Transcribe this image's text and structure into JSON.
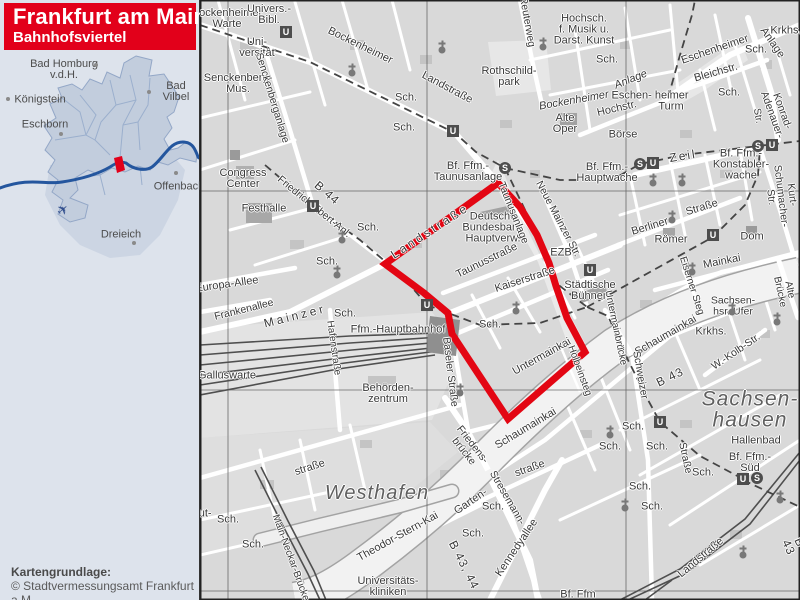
{
  "title": {
    "line1": "Frankfurt am Main",
    "line2": "Bahnhofsviertel"
  },
  "attribution": {
    "line1": "Kartengrundlage:",
    "line2": "© Stadtvermessungsamt Frankfurt a.M."
  },
  "colors": {
    "banner": "#e2001a",
    "boundary": "#e30613",
    "river_overview": "#24569e",
    "sidebar_bg": "#dde3ec"
  },
  "overview": {
    "plane_glyph": "✈",
    "towns": [
      {
        "name": "Bad Homburg\nv.d.H.",
        "x": 64,
        "y": 70,
        "dx": 96,
        "dy": 65
      },
      {
        "name": "Königstein",
        "x": 40,
        "y": 100,
        "dx": 8,
        "dy": 99
      },
      {
        "name": "Bad Vilbel",
        "x": 176,
        "y": 92,
        "dx": 149,
        "dy": 92
      },
      {
        "name": "Eschborn",
        "x": 45,
        "y": 125,
        "dx": 61,
        "dy": 134
      },
      {
        "name": "Offenbach",
        "x": 179,
        "y": 187,
        "dx": 176,
        "dy": 173
      },
      {
        "name": "Dreieich",
        "x": 121,
        "y": 235,
        "dx": 134,
        "dy": 243
      }
    ]
  },
  "map": {
    "labels": [
      {
        "t": "Bockenheimer\nWarte",
        "x": 27,
        "y": 19
      },
      {
        "t": "Univers.-\nBibl.",
        "x": 69,
        "y": 15
      },
      {
        "t": "Uni-\nversität",
        "x": 57,
        "y": 48
      },
      {
        "t": "Senckenberg-\nMus.",
        "x": 38,
        "y": 84
      },
      {
        "t": "Sch.",
        "x": 206,
        "y": 98
      },
      {
        "t": "Sch.",
        "x": 204,
        "y": 128
      },
      {
        "t": "Bockenheimer",
        "x": 160,
        "y": 46,
        "r": 26
      },
      {
        "t": "Landstraße",
        "x": 247,
        "y": 88,
        "r": 28
      },
      {
        "t": "Senckenberganlage",
        "x": 72,
        "y": 98,
        "r": 73,
        "s": 10.5
      },
      {
        "t": "Rothschild-\npark",
        "x": 309,
        "y": 77
      },
      {
        "t": "Reuterweg",
        "x": 327,
        "y": 22,
        "r": 80,
        "s": 10.5
      },
      {
        "t": "Hochsch.\nf. Musik u.\nDarst. Kunst",
        "x": 384,
        "y": 30
      },
      {
        "t": "Sch.",
        "x": 407,
        "y": 60
      },
      {
        "t": "Eschenheimer",
        "x": 515,
        "y": 50,
        "r": -19
      },
      {
        "t": "Anlage",
        "x": 572,
        "y": 43,
        "r": 55
      },
      {
        "t": "Krkhs.",
        "x": 586,
        "y": 31
      },
      {
        "t": "Sch.",
        "x": 556,
        "y": 50
      },
      {
        "t": "Sch.",
        "x": 529,
        "y": 93
      },
      {
        "t": "Bockenheimer",
        "x": 374,
        "y": 101,
        "r": -10,
        "it": 1
      },
      {
        "t": "Anlage",
        "x": 431,
        "y": 80,
        "r": -22,
        "it": 1
      },
      {
        "t": "Eschen- heimer",
        "x": 450,
        "y": 96
      },
      {
        "t": "Turm",
        "x": 471,
        "y": 107
      },
      {
        "t": "Hochstr.",
        "x": 417,
        "y": 109,
        "r": -13
      },
      {
        "t": "Alte\nOper",
        "x": 365,
        "y": 124
      },
      {
        "t": "Börse",
        "x": 423,
        "y": 135
      },
      {
        "t": "Bleichstr.",
        "x": 516,
        "y": 73,
        "r": -16
      },
      {
        "t": "Str.",
        "x": 557,
        "y": 116,
        "r": 80,
        "s": 10
      },
      {
        "t": "Konrad-Adenauer-",
        "x": 577,
        "y": 113,
        "r": 70,
        "s": 10.5
      },
      {
        "t": "Kurt-Schumacher-Str.",
        "x": 581,
        "y": 196,
        "r": 83,
        "s": 10.5
      },
      {
        "t": "Congress\nCenter",
        "x": 43,
        "y": 179
      },
      {
        "t": "Festhalle",
        "x": 64,
        "y": 209
      },
      {
        "t": "Friedrich-Ebert-Anl.",
        "x": 114,
        "y": 207,
        "r": 39,
        "s": 10.5
      },
      {
        "t": "B 44",
        "x": 127,
        "y": 193,
        "r": 41,
        "s": 12,
        "sp": 1
      },
      {
        "t": "Europa-Allee",
        "x": 27,
        "y": 285,
        "r": -8
      },
      {
        "t": "Frankenallee",
        "x": 44,
        "y": 310,
        "r": -14,
        "s": 10.5
      },
      {
        "t": "Mainzer",
        "x": 95,
        "y": 316,
        "r": -14,
        "s": 12,
        "sp": 3
      },
      {
        "t": "Landstraße",
        "x": 230,
        "y": 231,
        "r": -33,
        "s": 12,
        "sp": 3
      },
      {
        "t": "Hafenstraße",
        "x": 133,
        "y": 348,
        "r": 82,
        "s": 10
      },
      {
        "t": "Sch.",
        "x": 145,
        "y": 314
      },
      {
        "t": "Sch.",
        "x": 168,
        "y": 228
      },
      {
        "t": "Sch.",
        "x": 127,
        "y": 262
      },
      {
        "t": "Galluswarte",
        "x": 27,
        "y": 376
      },
      {
        "t": "straße",
        "x": 110,
        "y": 468,
        "r": -18
      },
      {
        "t": "Westhafen",
        "x": 177,
        "y": 493,
        "s": 20,
        "it": 1,
        "sp": 1,
        "c": "area"
      },
      {
        "t": "Main-Neckar-Brücke",
        "x": 90,
        "y": 558,
        "r": 70,
        "s": 10
      },
      {
        "t": "Sch.",
        "x": 28,
        "y": 520
      },
      {
        "t": "Sch.",
        "x": 53,
        "y": 545
      },
      {
        "t": "Gutleut-",
        "x": -8,
        "y": 514
      },
      {
        "t": "Behörden-\nzentrum",
        "x": 188,
        "y": 394
      },
      {
        "t": "Ffm.-Hauptbahnhof",
        "x": 198,
        "y": 330
      },
      {
        "t": "Bf. Ffm.-\nTaunusanlage",
        "x": 268,
        "y": 172
      },
      {
        "t": "Deutsche\nBundesbank\nHauptverw.",
        "x": 293,
        "y": 228
      },
      {
        "t": "Taunusstraße",
        "x": 287,
        "y": 261,
        "r": -26
      },
      {
        "t": "Kaiserstraße",
        "x": 325,
        "y": 280,
        "r": -18
      },
      {
        "t": "Taunusanlage",
        "x": 313,
        "y": 213,
        "r": 68,
        "s": 10.5
      },
      {
        "t": "Neue Mainzer Str.",
        "x": 358,
        "y": 219,
        "r": 62,
        "s": 10.5
      },
      {
        "t": "EZB",
        "x": 361,
        "y": 253
      },
      {
        "t": "Städtische\nBühnen",
        "x": 390,
        "y": 291
      },
      {
        "t": "Sch.",
        "x": 290,
        "y": 325
      },
      {
        "t": "Baseler Straße",
        "x": 250,
        "y": 372,
        "r": 83,
        "s": 10.5
      },
      {
        "t": "Untermainkai",
        "x": 342,
        "y": 357,
        "r": -29
      },
      {
        "t": "Holbeinsteg",
        "x": 379,
        "y": 371,
        "r": 70,
        "s": 10
      },
      {
        "t": "Theodor-Stern-Kai",
        "x": 198,
        "y": 537,
        "r": -29
      },
      {
        "t": "Universitäts-\nkliniken",
        "x": 188,
        "y": 587
      },
      {
        "t": "Garten-",
        "x": 271,
        "y": 502,
        "r": -34
      },
      {
        "t": "straße",
        "x": 330,
        "y": 469,
        "r": -20
      },
      {
        "t": "Sch.",
        "x": 293,
        "y": 507
      },
      {
        "t": "Sch.",
        "x": 273,
        "y": 534
      },
      {
        "t": "Friedens-\nbrücke",
        "x": 268,
        "y": 448,
        "r": 52,
        "s": 10.5
      },
      {
        "t": "B 43, 44",
        "x": 264,
        "y": 565,
        "r": 63,
        "s": 12,
        "sp": 1
      },
      {
        "t": "Stresemann-",
        "x": 307,
        "y": 498,
        "r": 60,
        "s": 10.5
      },
      {
        "t": "Kennedyallee",
        "x": 317,
        "y": 548,
        "r": -56
      },
      {
        "t": "Schaumainkai",
        "x": 326,
        "y": 429,
        "r": -31
      },
      {
        "t": "Schaumainkai",
        "x": 466,
        "y": 336,
        "r": -30
      },
      {
        "t": "Sachsen-\nhsr. Ufer",
        "x": 533,
        "y": 306,
        "s": 10.5
      },
      {
        "t": "Krkhs.",
        "x": 511,
        "y": 332
      },
      {
        "t": "W.-Kolb-Str.",
        "x": 536,
        "y": 352,
        "r": -34,
        "s": 10.5
      },
      {
        "t": "Sachsen-\nhausen",
        "x": 550,
        "y": 410,
        "s": 21,
        "it": 1,
        "sp": 1,
        "c": "area"
      },
      {
        "t": "Hallenbad",
        "x": 556,
        "y": 441
      },
      {
        "t": "Bf. Ffm.-\nSüd",
        "x": 550,
        "y": 463
      },
      {
        "t": "Sch.",
        "x": 433,
        "y": 427
      },
      {
        "t": "Sch.",
        "x": 410,
        "y": 447
      },
      {
        "t": "Sch.",
        "x": 457,
        "y": 447
      },
      {
        "t": "Sch.",
        "x": 440,
        "y": 487
      },
      {
        "t": "Sch.",
        "x": 452,
        "y": 507
      },
      {
        "t": "Sch.",
        "x": 503,
        "y": 473
      },
      {
        "t": "Straße",
        "x": 485,
        "y": 458,
        "r": 78,
        "s": 10.5
      },
      {
        "t": "Landstraße",
        "x": 501,
        "y": 558,
        "r": -40
      },
      {
        "t": "Zeil",
        "x": 483,
        "y": 156,
        "r": -9,
        "s": 12,
        "sp": 2
      },
      {
        "t": "Bf. Ffm.-\nHauptwache",
        "x": 407,
        "y": 173
      },
      {
        "t": "Bf. Ffm.-\nKonstabler-\nwache",
        "x": 541,
        "y": 165
      },
      {
        "t": "Berliner",
        "x": 450,
        "y": 227,
        "r": -17
      },
      {
        "t": "Straße",
        "x": 502,
        "y": 208,
        "r": -17
      },
      {
        "t": "Römer",
        "x": 471,
        "y": 240
      },
      {
        "t": "Dom",
        "x": 552,
        "y": 237
      },
      {
        "t": "Mainkai",
        "x": 522,
        "y": 262,
        "r": -11
      },
      {
        "t": "Eiserner Steg",
        "x": 491,
        "y": 286,
        "r": 72,
        "s": 10
      },
      {
        "t": "Alte Brücke",
        "x": 584,
        "y": 291,
        "r": 78,
        "s": 10
      },
      {
        "t": "Untermainbrücke",
        "x": 415,
        "y": 328,
        "r": 78,
        "s": 10
      },
      {
        "t": "Schweizer",
        "x": 440,
        "y": 375,
        "r": 80,
        "s": 10.5
      },
      {
        "t": "B 43",
        "x": 470,
        "y": 377,
        "r": -26,
        "s": 12,
        "sp": 1
      },
      {
        "t": "B 43",
        "x": 594,
        "y": 545,
        "r": 65,
        "s": 12,
        "sp": 1
      },
      {
        "t": "Bf. Ffm",
        "x": 378,
        "y": 595
      }
    ],
    "stations": [
      {
        "g": "U",
        "x": 86,
        "y": 32
      },
      {
        "g": "U",
        "x": 253,
        "y": 131
      },
      {
        "g": "U",
        "x": 113,
        "y": 206
      },
      {
        "g": "U",
        "x": 227,
        "y": 305
      },
      {
        "g": "U",
        "x": 390,
        "y": 270
      },
      {
        "g": "U",
        "x": 513,
        "y": 235
      },
      {
        "g": "U",
        "x": 453,
        "y": 163
      },
      {
        "g": "U",
        "x": 572,
        "y": 145
      },
      {
        "g": "U",
        "x": 460,
        "y": 422
      },
      {
        "g": "U",
        "x": 543,
        "y": 479
      },
      {
        "g": "S",
        "x": 305,
        "y": 168
      },
      {
        "g": "S",
        "x": 440,
        "y": 164
      },
      {
        "g": "S",
        "x": 558,
        "y": 146
      },
      {
        "g": "S",
        "x": 557,
        "y": 478
      }
    ],
    "churches": [
      [
        152,
        73
      ],
      [
        242,
        50
      ],
      [
        343,
        47
      ],
      [
        142,
        240
      ],
      [
        137,
        275
      ],
      [
        316,
        311
      ],
      [
        453,
        183
      ],
      [
        482,
        183
      ],
      [
        472,
        220
      ],
      [
        492,
        272
      ],
      [
        532,
        312
      ],
      [
        577,
        322
      ],
      [
        410,
        435
      ],
      [
        425,
        508
      ],
      [
        580,
        500
      ],
      [
        543,
        555
      ],
      [
        260,
        393
      ]
    ]
  }
}
